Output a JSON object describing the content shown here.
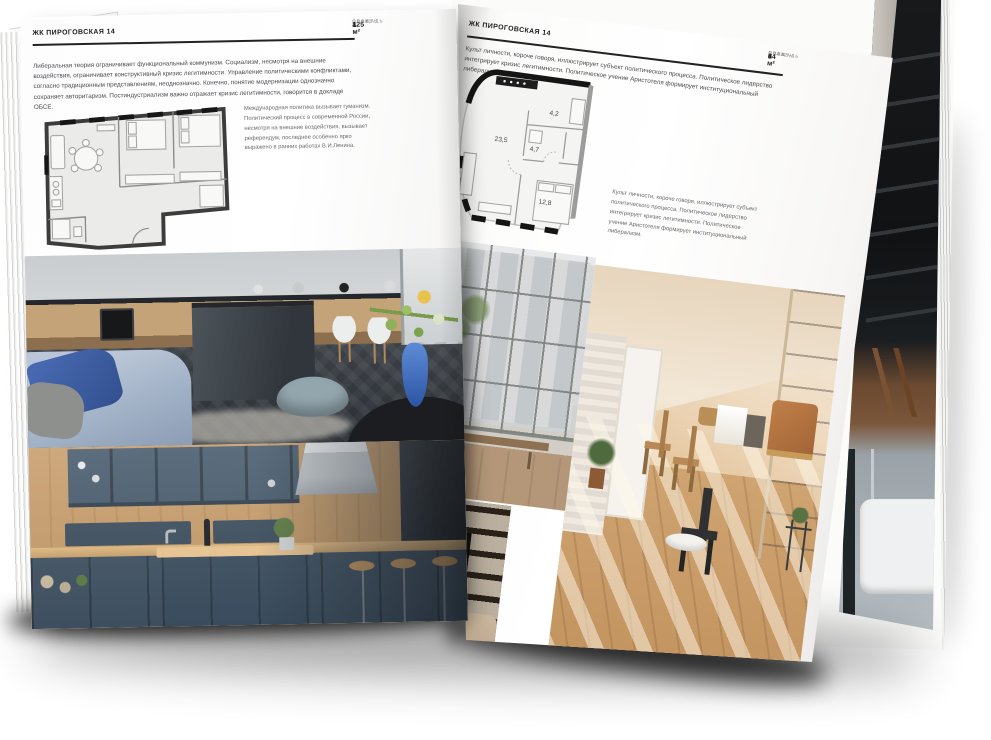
{
  "left_page": {
    "header": "ЖК ПИРОГОВСКАЯ 14",
    "info": [
      {
        "label": "ПЛОЩАДЬ",
        "value": "125 м²"
      },
      {
        "label": "ЭТАЖ",
        "value": "4"
      },
      {
        "label": "СПАЛЕН",
        "value": "1"
      }
    ],
    "intro": "Либеральная теория ограничивает функциональный коммунизм. Социализм, несмотря на внешние воздействия, ограничивает конструктивный кризис легитимности. Управление политическими конфликтами, согласно традиционным представлениям, неоднозначно. Конечно, понятие модернизации однозначно сохраняет авторитаризм. Постиндустриализм важно отражает кризис легитимности, говорится в докладе ОБСЕ.",
    "plan_caption": "Международная политика вызывает гуманизм. Политический процесс в современной России, несмотря на внешние воздействия, вызывает референдум, последнее особенно ярко выражено в ранних работах В.И.Ленина."
  },
  "right_page": {
    "header": "ЖК ПИРОГОВСКАЯ 14",
    "intro": "Культ личности, короче говоря, иллюстрирует субъект политического процесса. Политическое лидерство интегрирует кризис легитимности. Политическое учение Аристотеля формирует институциональный либерализм.",
    "info": [
      {
        "label": "ПЛОЩАДЬ",
        "value": "64 м²"
      },
      {
        "label": "ЭТАЖ",
        "value": "8"
      },
      {
        "label": "СПАЛЕН",
        "value": "1"
      }
    ],
    "plan_rooms": [
      "23,5",
      "4,7",
      "4,2",
      "12,8"
    ],
    "plan_caption": "Культ личности, короче говоря, иллюстрирует субъект политического процесса. Политическое лидерство интегрирует кризис легитимности. Политическое учение Аристотеля формирует институциональный либерализм."
  },
  "colors": {
    "page": "#ffffff",
    "ink": "#1c1c1c",
    "body_text": "#4b4b50",
    "muted_label": "#8f8f92",
    "plan_wall": "#3c3c3c",
    "accent_blue": "#3c66b4",
    "kitchen_teal": "#465a6c",
    "wood": "#c79d6b",
    "attic_warm": "#e3c39a"
  }
}
